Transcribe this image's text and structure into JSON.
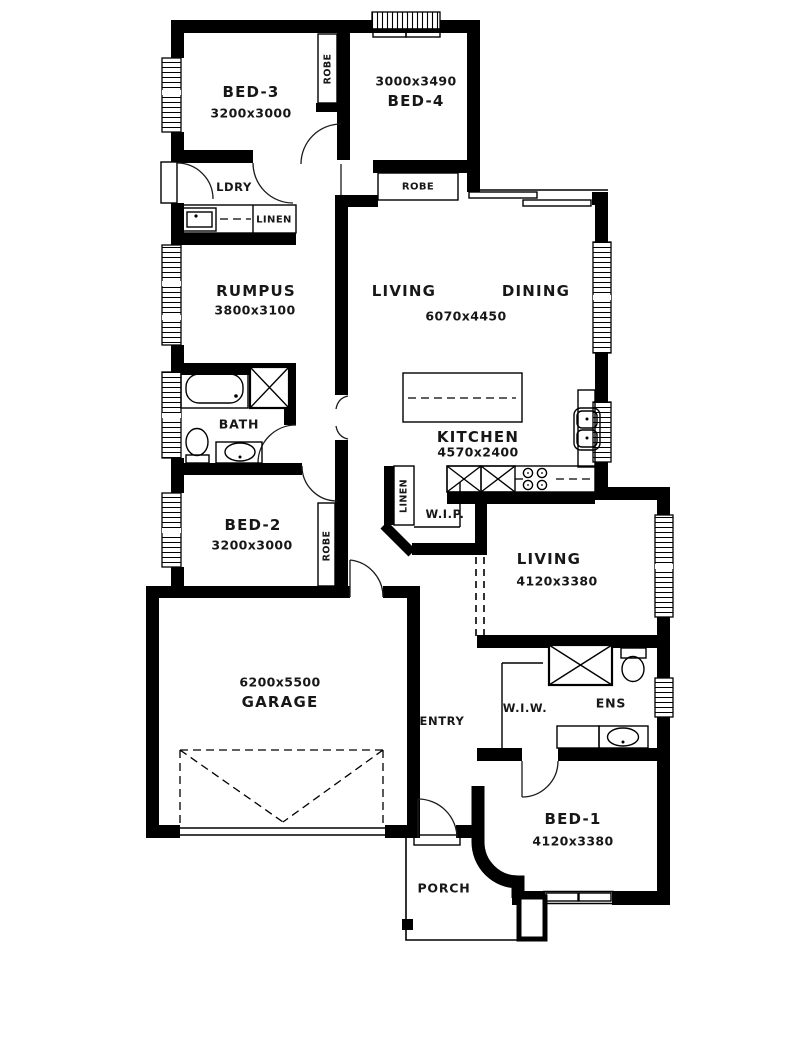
{
  "colors": {
    "wall": "#000000",
    "text": "#171717",
    "background": "#ffffff"
  },
  "rooms": {
    "bed3": {
      "name": "BED-3",
      "dims": "3200x3000"
    },
    "bed4": {
      "name": "BED-4",
      "dims": "3000x3490"
    },
    "rumpus": {
      "name": "RUMPUS",
      "dims": "3800x3100"
    },
    "living_dining": {
      "name_living": "LIVING",
      "name_dining": "DINING",
      "dims": "6070x4450"
    },
    "kitchen": {
      "name": "KITCHEN",
      "dims": "4570x2400"
    },
    "bed2": {
      "name": "BED-2",
      "dims": "3200x3000"
    },
    "living2": {
      "name": "LIVING",
      "dims": "4120x3380"
    },
    "garage": {
      "name": "GARAGE",
      "dims": "6200x5500"
    },
    "bed1": {
      "name": "BED-1",
      "dims": "4120x3380"
    },
    "bath": {
      "name": "BATH"
    },
    "ldry": {
      "name": "LDRY"
    },
    "linen_hall": {
      "name": "LINEN"
    },
    "linen_pantry": {
      "name": "LINEN"
    },
    "wip": {
      "name": "W.I.P."
    },
    "wiw": {
      "name": "W.I.W."
    },
    "ens": {
      "name": "ENS"
    },
    "entry": {
      "name": "ENTRY"
    },
    "porch": {
      "name": "PORCH"
    },
    "robe_bed34": {
      "name": "ROBE"
    },
    "robe_bed4": {
      "name": "ROBE"
    },
    "robe_bed2": {
      "name": "ROBE"
    }
  }
}
